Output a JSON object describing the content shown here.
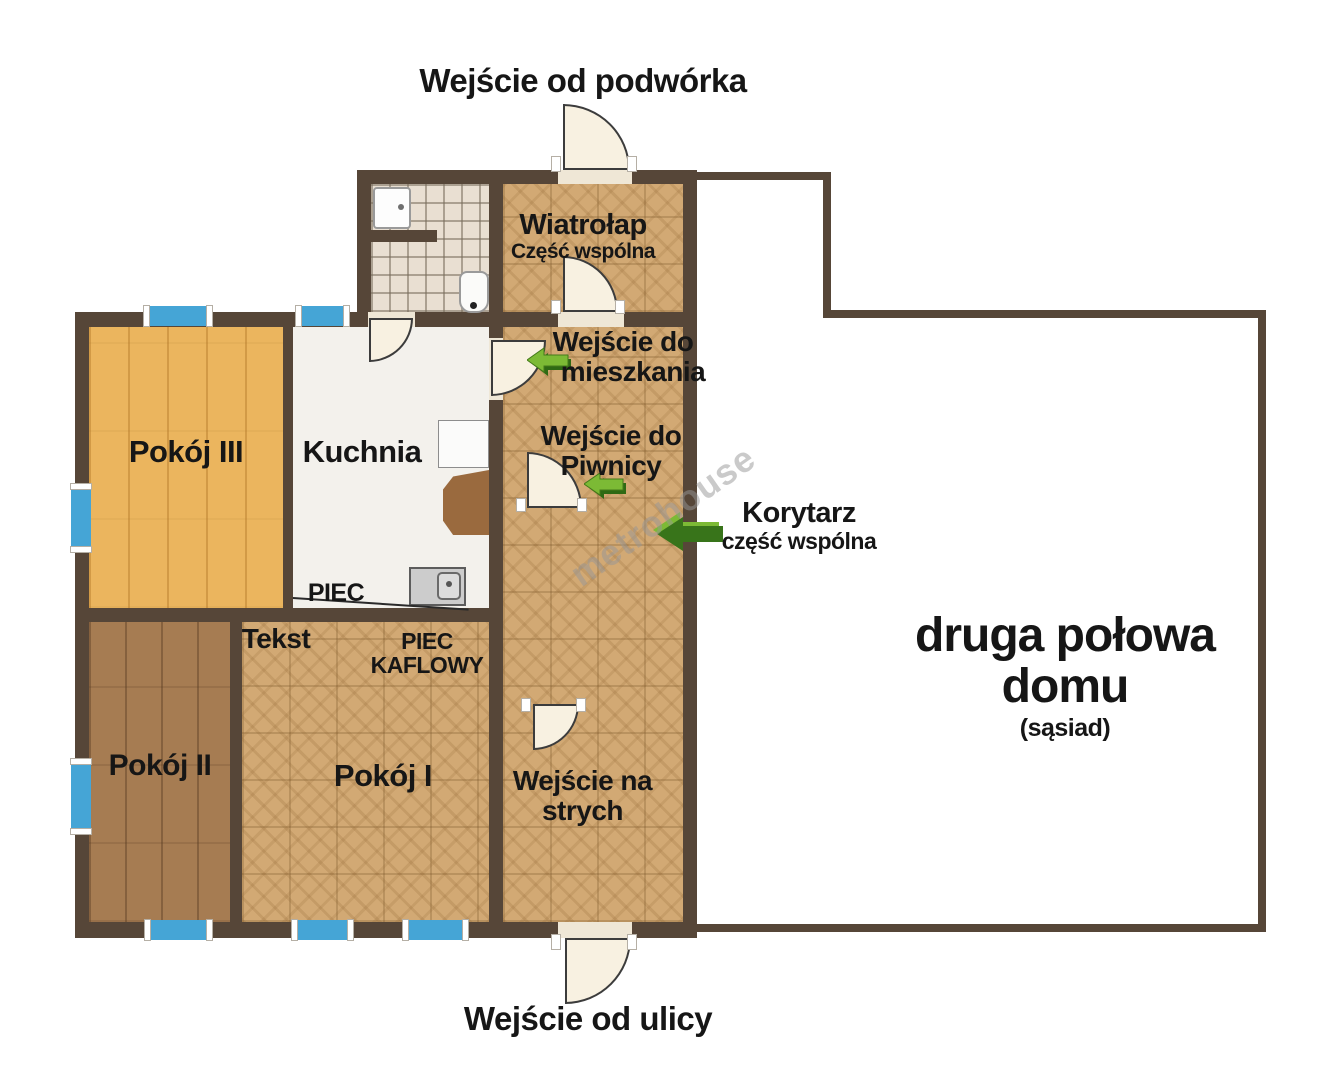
{
  "plan": {
    "labels": {
      "entrance_yard": "Wejście od podwórka",
      "entrance_street": "Wejście od ulicy"
    },
    "rooms": {
      "wiatrolap": {
        "name": "Wiatrołap",
        "subtitle": "Część wspólna"
      },
      "room3": {
        "name": "Pokój III"
      },
      "kitchen": {
        "name": "Kuchnia",
        "piec": "PIEC"
      },
      "room2": {
        "name": "Pokój II"
      },
      "room1": {
        "name": "Pokój I",
        "tekst": "Tekst",
        "piec_kaflowy_line1": "PIEC",
        "piec_kaflowy_line2": "KAFLOWY"
      },
      "neighbor": {
        "line1": "druga połowa",
        "line2": "domu",
        "line3": "(sąsiad)"
      }
    },
    "corridor": {
      "entrance_apartment": {
        "line1": "Wejście do",
        "line2": "mieszkania"
      },
      "entrance_basement": {
        "line1": "Wejście do",
        "line2": "Piwnicy"
      },
      "label": {
        "line1": "Korytarz",
        "line2": "część wspólna"
      },
      "entrance_attic": {
        "line1": "Wejście na",
        "line2": "strych"
      }
    },
    "watermark": "metrohouse",
    "colors": {
      "wall": "#564638",
      "parquet": "#d2a974",
      "wood_gold": "#ebb55e",
      "wood_brown": "#a67c52",
      "bath_tile": "#e9dfd2",
      "kitchen_floor": "#f3f1ec",
      "window_blue": "#45a5d6",
      "door_fill": "#f8f1e1",
      "arrow_light_green": "#7cba35",
      "arrow_dark_green": "#38741a",
      "text": "#161616"
    }
  }
}
